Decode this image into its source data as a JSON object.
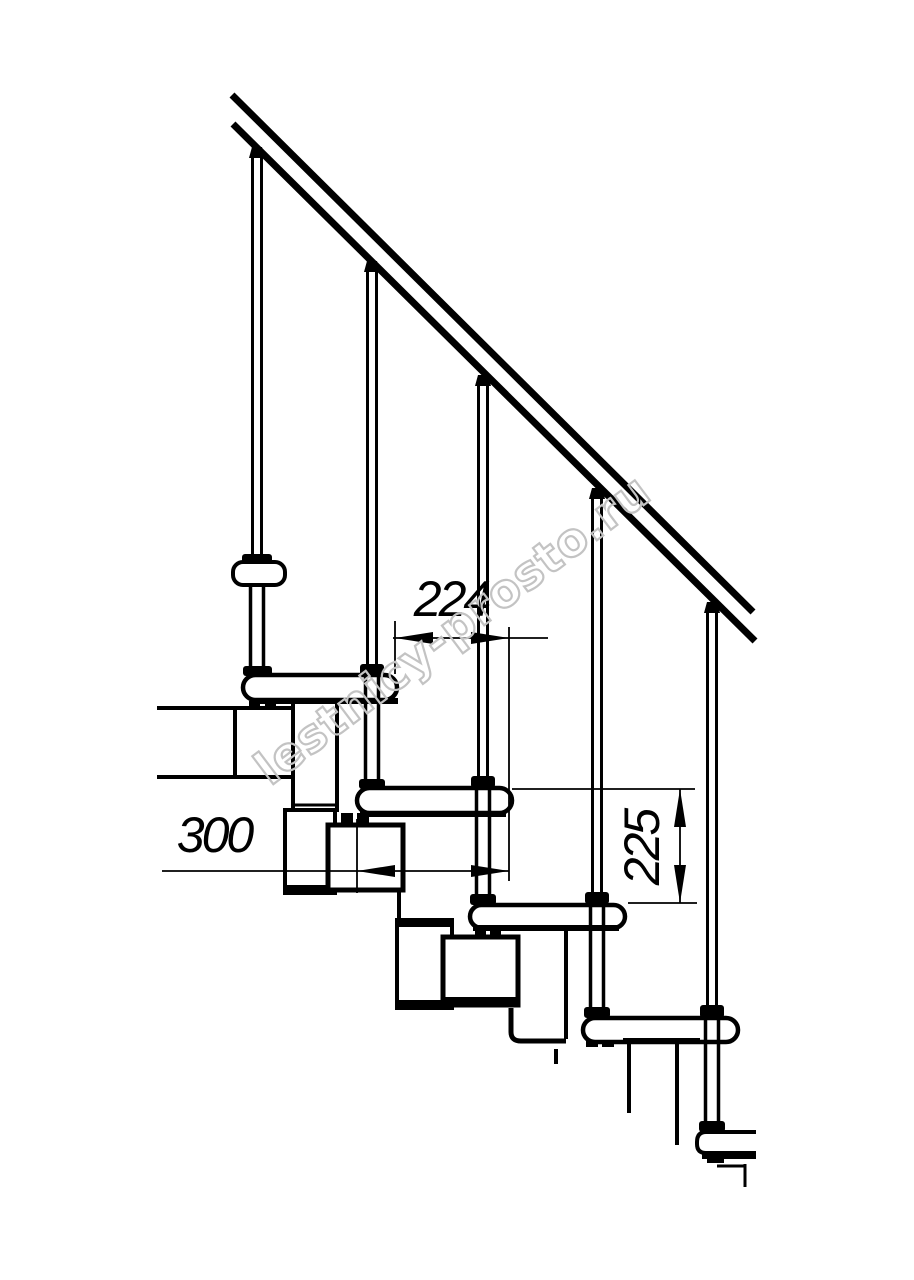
{
  "drawing": {
    "kind": "technical-drawing",
    "subject": "modular staircase side elevation",
    "line_color": "#000000",
    "background_color": "#ffffff"
  },
  "dimensions": {
    "going": {
      "value": "224"
    },
    "tread_depth": {
      "value": "300"
    },
    "rise": {
      "value": "225"
    }
  },
  "watermark": {
    "text": "lestnicy-prosto.ru",
    "color": "#c3c3c3"
  }
}
